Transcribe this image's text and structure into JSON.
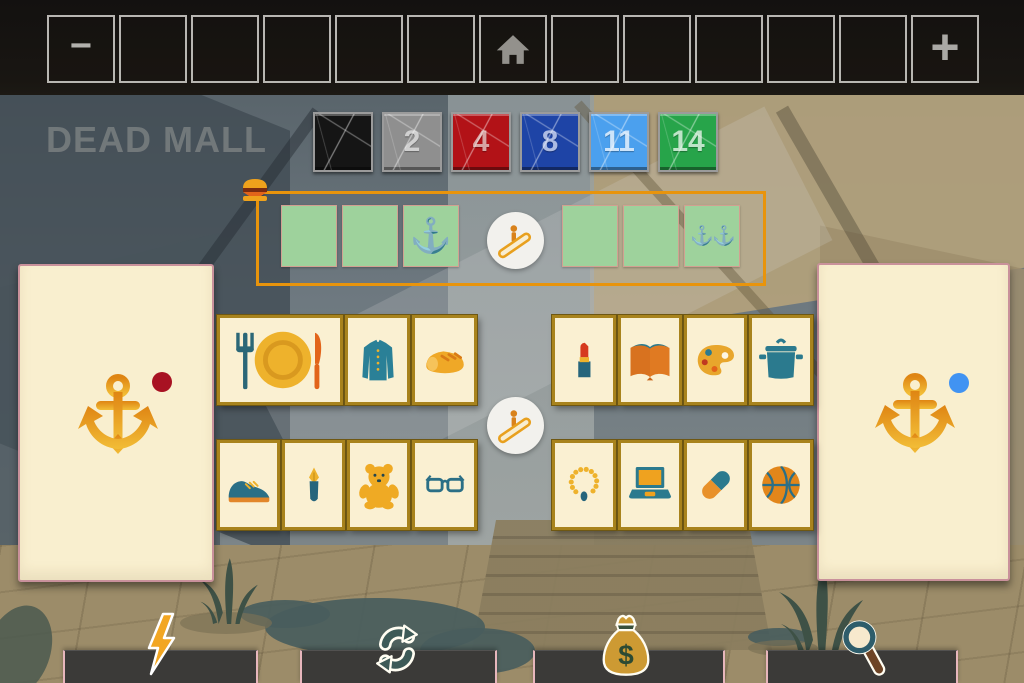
{
  "app": {
    "sign_text": "DEAD MALL"
  },
  "top_bar": {
    "minus_label": "−",
    "plus_label": "+",
    "slots_total": 13
  },
  "number_tiles": [
    {
      "label": "",
      "bg": "#151515",
      "fg": "#cccccc"
    },
    {
      "label": "2",
      "bg": "#8f8f8f",
      "fg": "#d8d8d8"
    },
    {
      "label": "4",
      "bg": "#b21217",
      "fg": "#dcb6b4"
    },
    {
      "label": "8",
      "bg": "#1e44a6",
      "fg": "#bcc8ea"
    },
    {
      "label": "11",
      "bg": "#4ba0ee",
      "fg": "#dcecfc"
    },
    {
      "label": "14",
      "bg": "#27a44a",
      "fg": "#cfecd6"
    }
  ],
  "sequence_row": {
    "slots": [
      {
        "glyph": ""
      },
      {
        "glyph": ""
      },
      {
        "glyph": "⚓"
      },
      {
        "glyph": ""
      },
      {
        "glyph": ""
      },
      {
        "glyph": "⚓⚓"
      }
    ]
  },
  "panels": {
    "left": {
      "icon": "anchor",
      "marker_color": "#a81222"
    },
    "right": {
      "icon": "anchor",
      "marker_color": "#4193f2"
    }
  },
  "shop_items": {
    "row1_left": [
      "meal",
      "shirt",
      "bread"
    ],
    "row1_right": [
      "lipstick",
      "book",
      "paint-palette",
      "cooking-pot"
    ],
    "row2_left": [
      "shoe",
      "fountain-pen",
      "teddy-bear",
      "glasses"
    ],
    "row2_right": [
      "necklace",
      "laptop",
      "pill",
      "basketball"
    ]
  },
  "bottom_actions": [
    "energy",
    "refresh",
    "money",
    "search"
  ],
  "money_symbol": "$",
  "colors": {
    "sequence_outline": "#e8940c",
    "slot_green": "#9ed29c",
    "card_cream": "#faf0d2",
    "card_border": "#a8831d",
    "anchor_gold_top": "#df8513",
    "anchor_gold_bottom": "#f2bd37",
    "teal": "#2b7a8e",
    "accent_orange": "#e2641a"
  }
}
